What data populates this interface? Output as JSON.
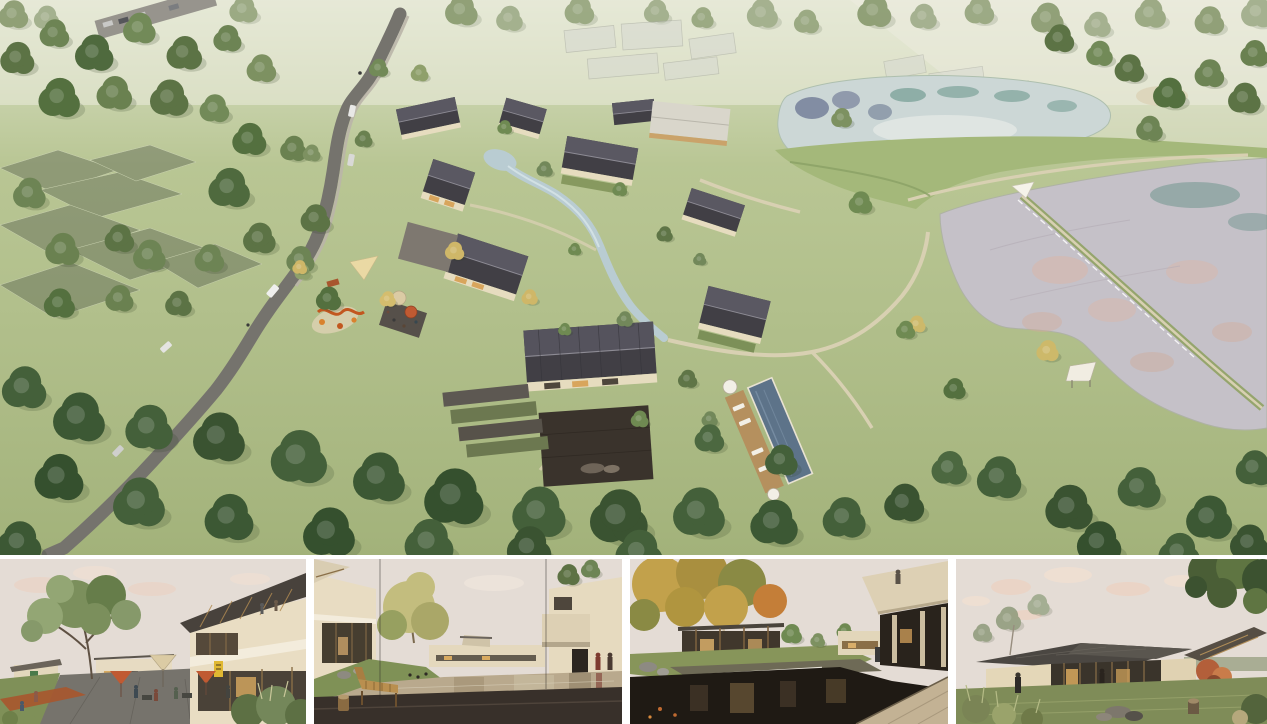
{
  "board": {
    "title": "Architectural rendering board — lakeside village resort"
  },
  "palette": {
    "grass": "#afbe85",
    "grass_dark": "#8fa468",
    "road": "#75736d",
    "sidewalk": "#bab5a8",
    "roof_dark": "#413f45",
    "roof_light": "#5a5862",
    "roof_pale": "#d9d6cb",
    "wall_cream": "#e6dcbf",
    "interior_warm": "#d8a55c",
    "water_upper": "#ccd7d6",
    "water_lower": "#c5c1c8",
    "reflection_pink": "#dcb6a6",
    "reflection_teal": "#4f8577",
    "reflection_blue": "#46507a",
    "pool": "#5d7389",
    "pool_deck": "#b5905e",
    "path": "#d8d0b2",
    "stream": "#b9ccd2",
    "canopy_dark": "#44603a",
    "canopy_mid": "#5c7345",
    "canopy_light": "#6d8454",
    "canopy_pale": "#8fa06b",
    "autumn": "#cfb768",
    "playground_orange": "#c2571f",
    "umbrella_red": "#c05a32",
    "umbrella_beige": "#dbcba4",
    "sign_yellow": "#e0b832",
    "paving_dark": "#3a332c",
    "stone_warm": "#c3b294",
    "bench_wood": "#b98f4f",
    "sky": "#e4dcd5",
    "cloud_pink": "#ecd2c2",
    "ghost_grey": "#d7d9d2"
  },
  "main_render": {
    "label": "Aerial rendering — village resort masterplan: winding road with cars through woodland, ghosted field plots, courtyard houses with dark pitched roofs, stream, swimming pool, playground and cafe terraces, upper pond and lower pond divided by a grass dike with footpaths and a weir causeway",
    "features": [
      "winding access road with cars and cyclist",
      "parking strip at top left",
      "woodland groves",
      "ghosted field plots",
      "ghost massing of future buildings",
      "village cluster of gable-roof houses",
      "central hall with stone courtyard",
      "stream through the village",
      "swimming pool with timber deck and loungers",
      "playground with shade sail",
      "cafe terrace umbrellas",
      "upper pond with tree reflections",
      "grass dike footpath",
      "lower pond with pink sky reflections",
      "weir causeway with shade sail",
      "lakeside shade canopy",
      "dense tree canopy along lower edge"
    ]
  },
  "thumbnails": [
    {
      "label": "Street view — cafe terrace with red and beige umbrellas beneath a large tree, two-storey timber-roofed building with yellow sign"
    },
    {
      "label": "Courtyard view — reflecting pond ringed by cream buildings, timber lounge bench and log stool on dark paving, two figures walking"
    },
    {
      "label": "Garden court — dark pond with waterfall weir, autumn plane tree, cantilevered cream balcony with a visitor above stone paving"
    },
    {
      "label": "Lakeside pavilion — glazed single-storey house with dark low roof at dusk, maple and overhanging tree, rocks and stump on the lawn"
    }
  ]
}
